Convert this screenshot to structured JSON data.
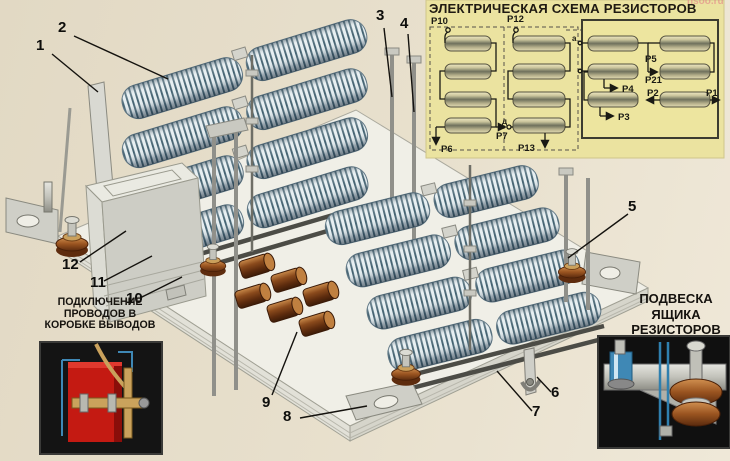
{
  "poster": {
    "title": "ЭЛЕКТРИЧЕСКАЯ СХЕМА РЕЗИСТОРОВ",
    "watermark": "nsoo.ru"
  },
  "schematic": {
    "labels": {
      "p10": "Р10",
      "p12": "Р12",
      "p6": "Р6",
      "p7": "Р7",
      "p13": "Р13",
      "p5": "Р5",
      "p21": "Р21",
      "p4": "Р4",
      "p3": "Р3",
      "p2": "Р2",
      "p1": "Р1",
      "a": "а",
      "d": "д"
    },
    "groups": [
      {
        "name": "left-dashed-group",
        "resistors": 4,
        "terminals": [
          "Р10",
          "Р6",
          "Р7"
        ]
      },
      {
        "name": "middle-dashed-group",
        "resistors": 4,
        "terminals": [
          "Р12",
          "Р13",
          "д"
        ]
      },
      {
        "name": "right-solid-box",
        "resistors": 6,
        "terminals": [
          "Р5",
          "Р21",
          "Р4",
          "Р3",
          "Р2",
          "Р1",
          "а"
        ]
      }
    ]
  },
  "callouts": [
    "1",
    "2",
    "3",
    "4",
    "5",
    "6",
    "7",
    "8",
    "9",
    "10",
    "11",
    "12"
  ],
  "captions": {
    "terminal_box": [
      "ПОДКЛЮЧЕНИЕ",
      "ПРОВОДОВ В",
      "КОРОБКЕ ВЫВОДОВ"
    ],
    "suspension": [
      "ПОДВЕСКА",
      "ЯЩИКА",
      "РЕЗИСТОРОВ"
    ]
  },
  "colors": {
    "background": "#e6ddc9",
    "schematic_panel": "#ebe3a0",
    "coil_stripe": "#41606f",
    "coil_light": "#e4edf0",
    "copper": "#8a4a1c",
    "steel": "#c2c2ba",
    "inset_red": "#c41a12",
    "inset_blue": "#3f88b5",
    "text": "#171410"
  }
}
